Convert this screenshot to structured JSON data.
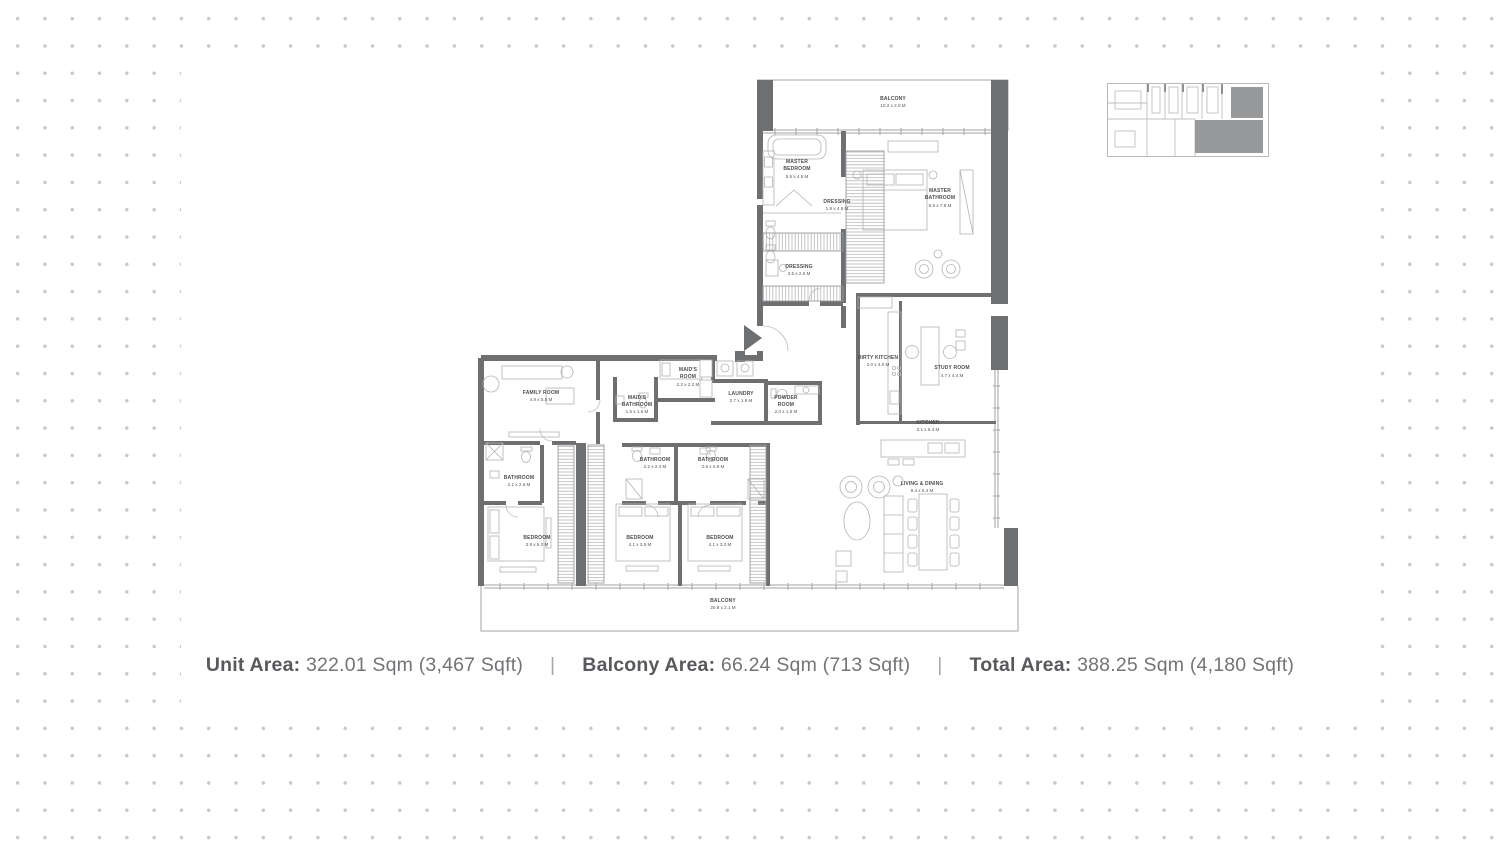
{
  "canvas": {
    "dot_color": "#c8c9cb",
    "panel_color": "#ffffff"
  },
  "floorplan": {
    "wall_color": "#6e6f71",
    "line_color": "#a2a4a6",
    "label_color": "#4c4d4f",
    "rooms": [
      {
        "id": "balcony-top",
        "lines": [
          "BALCONY"
        ],
        "dims": "10.2 x 2.0 M"
      },
      {
        "id": "master-bedroom",
        "lines": [
          "MASTER",
          "BEDROOM"
        ],
        "dims": "5.5 x 4.5 M"
      },
      {
        "id": "dressing-1",
        "lines": [
          "DRESSING"
        ],
        "dims": "1.8 x 4.5 M"
      },
      {
        "id": "master-bathroom",
        "lines": [
          "MASTER",
          "BATHROOM"
        ],
        "dims": "5.5 x 7.5 M"
      },
      {
        "id": "dressing-2",
        "lines": [
          "DRESSING"
        ],
        "dims": "3.5 x 2.5 M"
      },
      {
        "id": "dirty-kitchen",
        "lines": [
          "DIRTY KITCHEN"
        ],
        "dims": "2.0 x 4.0 M"
      },
      {
        "id": "study-room",
        "lines": [
          "STUDY ROOM"
        ],
        "dims": "4.7 x 4.4 M"
      },
      {
        "id": "maids-room",
        "lines": [
          "MAID'S",
          "ROOM"
        ],
        "dims": "2.2 x 2.2 M"
      },
      {
        "id": "maids-bathroom",
        "lines": [
          "MAID'S",
          "BATHROOM"
        ],
        "dims": "1.5 x 1.6 M"
      },
      {
        "id": "laundry",
        "lines": [
          "LAUNDRY"
        ],
        "dims": "2.7 x 1.9 M"
      },
      {
        "id": "powder-room",
        "lines": [
          "POWDER",
          "ROOM"
        ],
        "dims": "2.0 x 1.5 M"
      },
      {
        "id": "family-room",
        "lines": [
          "FAMILY ROOM"
        ],
        "dims": "4.8 x 5.5 M"
      },
      {
        "id": "kitchen",
        "lines": [
          "KITCHEN"
        ],
        "dims": "3.1 x 5.4 M"
      },
      {
        "id": "living-dining",
        "lines": [
          "LIVING & DINING"
        ],
        "dims": "9.4 x 6.4 M"
      },
      {
        "id": "bathroom-1",
        "lines": [
          "BATHROOM"
        ],
        "dims": "2.1 x 2.6 M"
      },
      {
        "id": "bathroom-2",
        "lines": [
          "BATHROOM"
        ],
        "dims": "2.2 x 2.4 M"
      },
      {
        "id": "bathroom-3",
        "lines": [
          "BATHROOM"
        ],
        "dims": "2.6 x 2.8 M"
      },
      {
        "id": "bedroom-1",
        "lines": [
          "BEDROOM"
        ],
        "dims": "3.9 x 5.2 M"
      },
      {
        "id": "bedroom-2",
        "lines": [
          "BEDROOM"
        ],
        "dims": "4.1 x 3.5 M"
      },
      {
        "id": "bedroom-3",
        "lines": [
          "BEDROOM"
        ],
        "dims": "4.1 x 3.2 M"
      },
      {
        "id": "balcony-bottom",
        "lines": [
          "BALCONY"
        ],
        "dims": "20.8 x 2.1 M"
      }
    ]
  },
  "keyplan": {
    "highlight_color": "#98999b"
  },
  "stats": {
    "separator": "|",
    "items": [
      {
        "label": "Unit Area:",
        "value": "322.01 Sqm (3,467 Sqft)"
      },
      {
        "label": "Balcony Area:",
        "value": "66.24 Sqm (713 Sqft)"
      },
      {
        "label": "Total Area:",
        "value": "388.25 Sqm (4,180 Sqft)"
      }
    ]
  }
}
